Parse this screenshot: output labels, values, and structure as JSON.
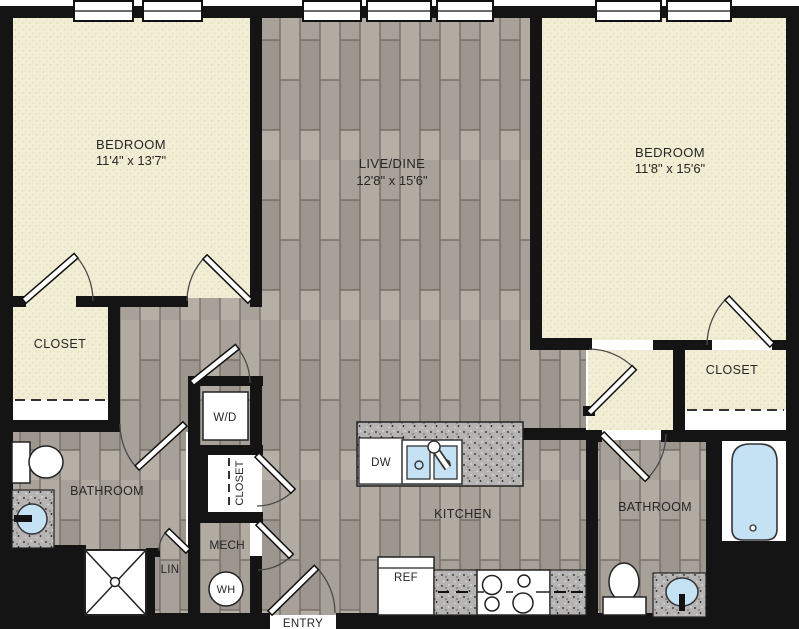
{
  "floorplan": {
    "rooms": {
      "bedroom_left": {
        "label": "BEDROOM",
        "dims": "11'4\" x 13'7\""
      },
      "live_dine": {
        "label": "LIVE/DINE",
        "dims": "12'8\" x 15'6\""
      },
      "bedroom_right": {
        "label": "BEDROOM",
        "dims": "11'8\" x 15'6\""
      },
      "closet_left": {
        "label": "CLOSET"
      },
      "closet_right": {
        "label": "CLOSET"
      },
      "closet_hall": {
        "label": "CLOSET"
      },
      "bathroom_left": {
        "label": "BATHROOM"
      },
      "bathroom_right": {
        "label": "BATHROOM"
      },
      "kitchen": {
        "label": "KITCHEN"
      },
      "mech": {
        "label": "MECH"
      },
      "linen": {
        "label": "LIN"
      },
      "entry": {
        "label": "ENTRY"
      }
    },
    "appliances": {
      "washer_dryer": "W/D",
      "water_heater": "WH",
      "dishwasher": "DW",
      "refrigerator": "REF"
    },
    "colors": {
      "wall": "#141414",
      "carpet": "#f2eed5",
      "wood": "#a8a199",
      "counter_speckle": "#b5b4b2",
      "fixture_blue": "#c4e2f4"
    }
  }
}
